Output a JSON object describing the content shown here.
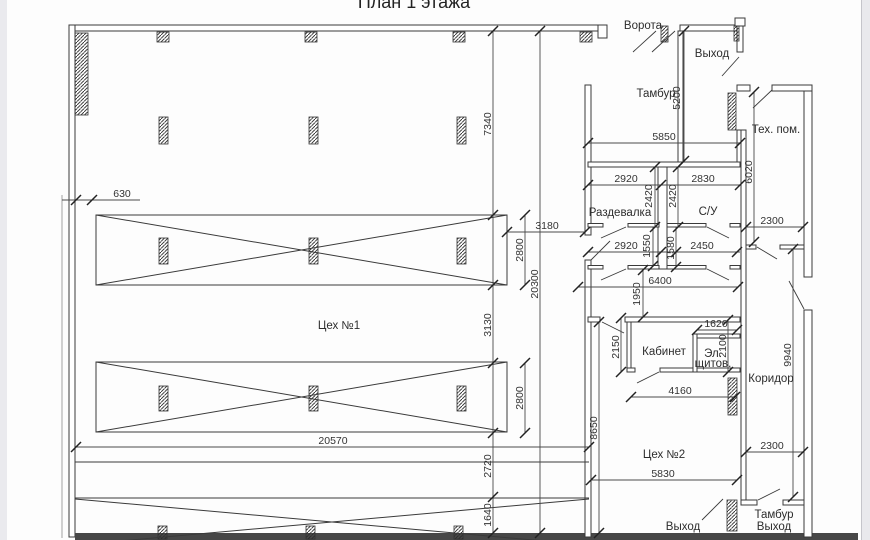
{
  "title": "План 1 этажа",
  "rooms": {
    "workshop1": "Цех №1",
    "workshop2": "Цех №2",
    "dressing": "Раздевалка",
    "bathroom": "С/У",
    "office": "Кабинет",
    "panel_line1": "Эл.",
    "panel_line2": "щитов.",
    "corridor": "Коридор",
    "tech_room": "Тех. пом.",
    "tambour_top": "Тамбур",
    "gate": "Ворота",
    "exit_top": "Выход",
    "exit_bottom": "Выход",
    "tambour_exit_line1": "Тамбур",
    "tambour_exit_line2": "Выход"
  },
  "dimensions": {
    "d630": "630",
    "d7340": "7340",
    "d3180": "3180",
    "d2800_upper": "2800",
    "d20300": "20300",
    "d3130": "3130",
    "d2800_lower": "2800",
    "d2720": "2720",
    "d1640": "1640",
    "d20570": "20570",
    "d8650": "8650",
    "d5830": "5830",
    "d5200": "5200",
    "d5850": "5850",
    "d2920_upper": "2920",
    "d2830": "2830",
    "d2420_left": "2420",
    "d2420_right": "2420",
    "d2920_lower": "2920",
    "d1550": "1550",
    "d1580": "1580",
    "d2450": "2450",
    "d6400": "6400",
    "d1950": "1950",
    "d6020": "6020",
    "d2300_upper": "2300",
    "d2300_lower": "2300",
    "d2150": "2150",
    "d1620": "1620",
    "d2100": "2100",
    "d4160": "4160",
    "d9940": "9940"
  },
  "colors": {
    "line": "#3a3a3a",
    "background": "#fdfdfd",
    "edge_strip": "#e9e9ed",
    "bottom_band": "#474747"
  }
}
